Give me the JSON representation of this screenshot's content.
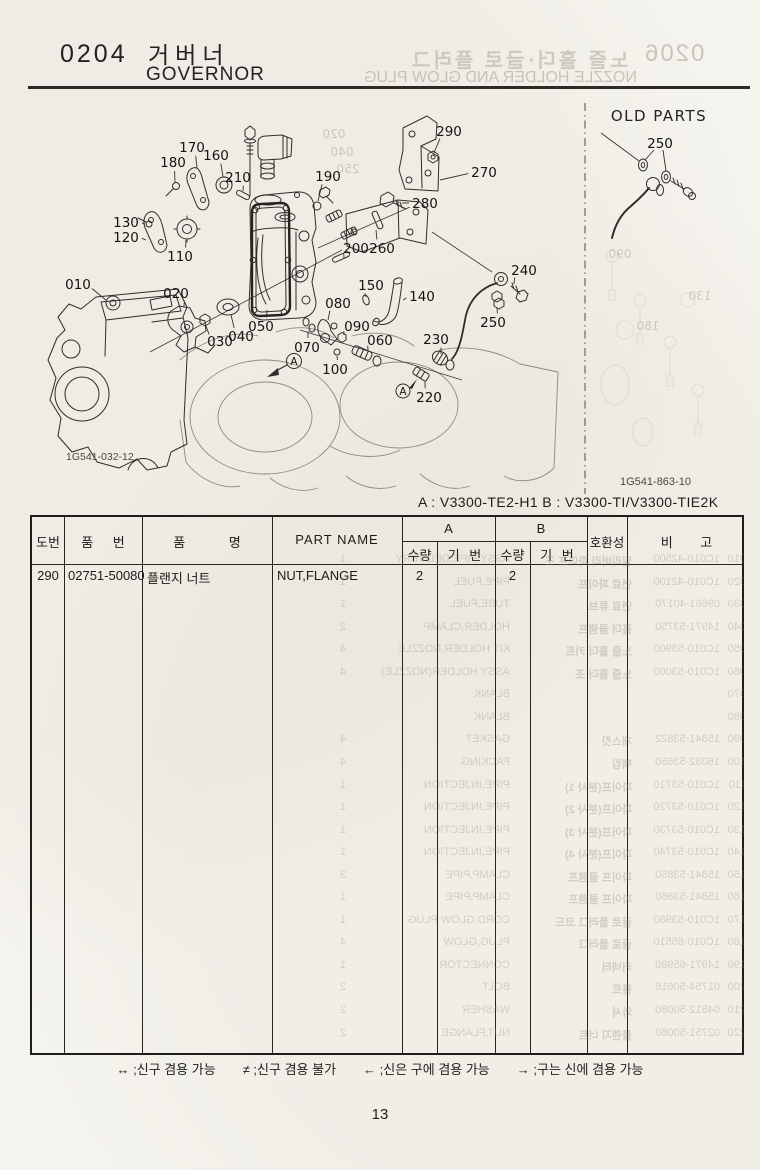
{
  "header": {
    "section_no": "0204",
    "title_ko": "거버너",
    "title_en": "GOVERNOR"
  },
  "bleed_through": {
    "header": {
      "section_no": "0206",
      "title_ko": "노즐 홀더·글로 플러그",
      "title_en": "NOZZLE HOLDER AND GLOW PLUG"
    },
    "diagram_ghost_labels": [
      {
        "label": "020",
        "x": 334,
        "y": 138
      },
      {
        "label": "040",
        "x": 342,
        "y": 156
      },
      {
        "label": "250",
        "x": 348,
        "y": 173
      },
      {
        "label": "090",
        "x": 620,
        "y": 258
      },
      {
        "label": "180",
        "x": 648,
        "y": 330
      },
      {
        "label": "130",
        "x": 700,
        "y": 300
      }
    ],
    "table_rows": [
      {
        "num": "010",
        "part": "1C010-42500",
        "ko": "딜리버리 파이프 조",
        "en": "ASSY PIPE,DELIVERY",
        "qty": "1"
      },
      {
        "num": "020",
        "part": "1C010-42100",
        "ko": "연료 파이프",
        "en": "PIPE,FUEL",
        "qty": "1"
      },
      {
        "num": "030",
        "part": "09661-40170",
        "ko": "연료 튜브",
        "en": "TUBE,FUEL",
        "qty": "1"
      },
      {
        "num": "040",
        "part": "14971-53750",
        "ko": "홀더 클램프",
        "en": "HOLDER,CLAMP",
        "qty": "2"
      },
      {
        "num": "050",
        "part": "1C010-53900",
        "ko": "노즐 홀더 키트",
        "en": "KIT HOLDER,NOZZLE",
        "qty": "4"
      },
      {
        "num": "060",
        "part": "1C010-53000",
        "ko": "노즐 홀더 조",
        "en": "ASSY HOLDER(NOZZLE)",
        "qty": "4"
      },
      {
        "num": "070",
        "part": "",
        "ko": "",
        "en": "BLANK",
        "qty": ""
      },
      {
        "num": "080",
        "part": "",
        "ko": "",
        "en": "BLANK",
        "qty": ""
      },
      {
        "num": "090",
        "part": "15841-53822",
        "ko": "개스킷",
        "en": "GASKET",
        "qty": "4"
      },
      {
        "num": "100",
        "part": "16032-53650",
        "ko": "팩킹",
        "en": "PACKING",
        "qty": "4"
      },
      {
        "num": "110",
        "part": "1C010-53710",
        "ko": "파이프(분사 1)",
        "en": "PIPE,INJECTION",
        "qty": "1"
      },
      {
        "num": "120",
        "part": "1C010-53720",
        "ko": "파이프(분사 2)",
        "en": "PIPE,INJECTION",
        "qty": "1"
      },
      {
        "num": "130",
        "part": "1C010-53730",
        "ko": "파이프(분사 3)",
        "en": "PIPE,INJECTION",
        "qty": "1"
      },
      {
        "num": "140",
        "part": "1C010-53740",
        "ko": "파이프(분사 4)",
        "en": "PIPE,INJECTION",
        "qty": "1"
      },
      {
        "num": "150",
        "part": "15841-53850",
        "ko": "파이프 클램프",
        "en": "CLAMP,PIPE",
        "qty": "3"
      },
      {
        "num": "160",
        "part": "15841-53860",
        "ko": "파이프 클램프",
        "en": "CLAMP,PIPE",
        "qty": "1"
      },
      {
        "num": "170",
        "part": "1C010-53980",
        "ko": "글로 플러그 코드",
        "en": "CORD,GLOW PLUG",
        "qty": "1"
      },
      {
        "num": "180",
        "part": "1C010-65510",
        "ko": "글로 플러그",
        "en": "PLUG,GLOW",
        "qty": "4"
      },
      {
        "num": "190",
        "part": "14971-65980",
        "ko": "커넥터",
        "en": "CONNECTOR",
        "qty": "1"
      },
      {
        "num": "200",
        "part": "01754-50616",
        "ko": "볼트",
        "en": "BOLT",
        "qty": "2"
      },
      {
        "num": "210",
        "part": "04512-50080",
        "ko": "와셔",
        "en": "WASHER",
        "qty": "2"
      },
      {
        "num": "220",
        "part": "02751-50080",
        "ko": "플랜지 너트",
        "en": "NUT,FLANGE",
        "qty": "2"
      }
    ]
  },
  "diagram": {
    "old_parts_label": "OLD PARTS",
    "code_left": "1G541-032-12",
    "code_right": "1G541-863-10",
    "marker_a": "A",
    "callouts": [
      {
        "label": "010",
        "x": 78,
        "y": 284,
        "tx": 106,
        "ty": 300
      },
      {
        "label": "020",
        "x": 176,
        "y": 293,
        "tx": 184,
        "ty": 306
      },
      {
        "label": "030",
        "x": 220,
        "y": 341,
        "tx": 206,
        "ty": 326
      },
      {
        "label": "040",
        "x": 241,
        "y": 336,
        "tx": 231,
        "ty": 315
      },
      {
        "label": "050",
        "x": 261,
        "y": 326,
        "tx": 267,
        "ty": 310
      },
      {
        "label": "060",
        "x": 380,
        "y": 340,
        "tx": 368,
        "ty": 350
      },
      {
        "label": "070",
        "x": 307,
        "y": 347,
        "tx": 308,
        "ty": 331
      },
      {
        "label": "080",
        "x": 338,
        "y": 303,
        "tx": 328,
        "ty": 320
      },
      {
        "label": "090",
        "x": 357,
        "y": 326,
        "tx": 344,
        "ty": 335
      },
      {
        "label": "100",
        "x": 335,
        "y": 369,
        "tx": 337,
        "ty": 356
      },
      {
        "label": "110",
        "x": 180,
        "y": 256,
        "tx": 186,
        "ty": 240
      },
      {
        "label": "120",
        "x": 126,
        "y": 237,
        "tx": 146,
        "ty": 240
      },
      {
        "label": "130",
        "x": 126,
        "y": 222,
        "tx": 145,
        "ty": 224
      },
      {
        "label": "140",
        "x": 422,
        "y": 296,
        "tx": 403,
        "ty": 300
      },
      {
        "label": "150",
        "x": 371,
        "y": 285,
        "tx": 366,
        "ty": 297
      },
      {
        "label": "160",
        "x": 216,
        "y": 155,
        "tx": 223,
        "ty": 177
      },
      {
        "label": "170",
        "x": 192,
        "y": 147,
        "tx": 197,
        "ty": 168
      },
      {
        "label": "180",
        "x": 173,
        "y": 162,
        "tx": 175,
        "ty": 182
      },
      {
        "label": "190",
        "x": 328,
        "y": 176,
        "tx": 318,
        "ty": 201
      },
      {
        "label": "200",
        "x": 356,
        "y": 248,
        "tx": 344,
        "ty": 258
      },
      {
        "label": "210",
        "x": 238,
        "y": 177,
        "tx": 243,
        "ty": 191
      },
      {
        "label": "220",
        "x": 429,
        "y": 397,
        "tx": 425,
        "ty": 381
      },
      {
        "label": "230",
        "x": 436,
        "y": 339,
        "tx": 441,
        "ty": 354
      },
      {
        "label": "240",
        "x": 524,
        "y": 270,
        "tx": 514,
        "ty": 284
      },
      {
        "label": "250",
        "x": 493,
        "y": 322,
        "tx": 497,
        "ty": 308
      },
      {
        "label": "260",
        "x": 382,
        "y": 248,
        "tx": 376,
        "ty": 230
      },
      {
        "label": "270",
        "x": 484,
        "y": 172,
        "tx": 440,
        "ty": 180
      },
      {
        "label": "280",
        "x": 425,
        "y": 203,
        "tx": 402,
        "ty": 203
      },
      {
        "label": "290",
        "x": 449,
        "y": 131,
        "tx": 434,
        "ty": 153
      },
      {
        "label": "250",
        "x": 660,
        "y": 143,
        "tx": null,
        "ty": null
      }
    ]
  },
  "models_line": "A : V3300-TE2-H1   B : V3300-TI/V3300-TIE2K",
  "table": {
    "columns": {
      "fig": "도번",
      "part_no": "품 번",
      "name_ko": "품 명",
      "part_name": "PART NAME",
      "compat": "호환성",
      "remarks": "비 고"
    },
    "groups": {
      "a": "A",
      "b": "B"
    },
    "sub": {
      "qty": "수량",
      "serial": "기 번"
    },
    "rows": [
      {
        "fig": "290",
        "part_no": "02751-50080",
        "name_ko": "플랜지 너트",
        "part_name": "NUT,FLANGE",
        "a_qty": "2",
        "a_serial": "",
        "b_qty": "2",
        "b_serial": "",
        "compat": "",
        "remarks": ""
      }
    ]
  },
  "legend": {
    "items": [
      "↔ ;신구 겸용 가능",
      "≠ ;신구 겸용 불가",
      "← ;신은 구에 겸용 가능",
      "→ ;구는 신에 겸용 가능"
    ]
  },
  "page_number": "13"
}
